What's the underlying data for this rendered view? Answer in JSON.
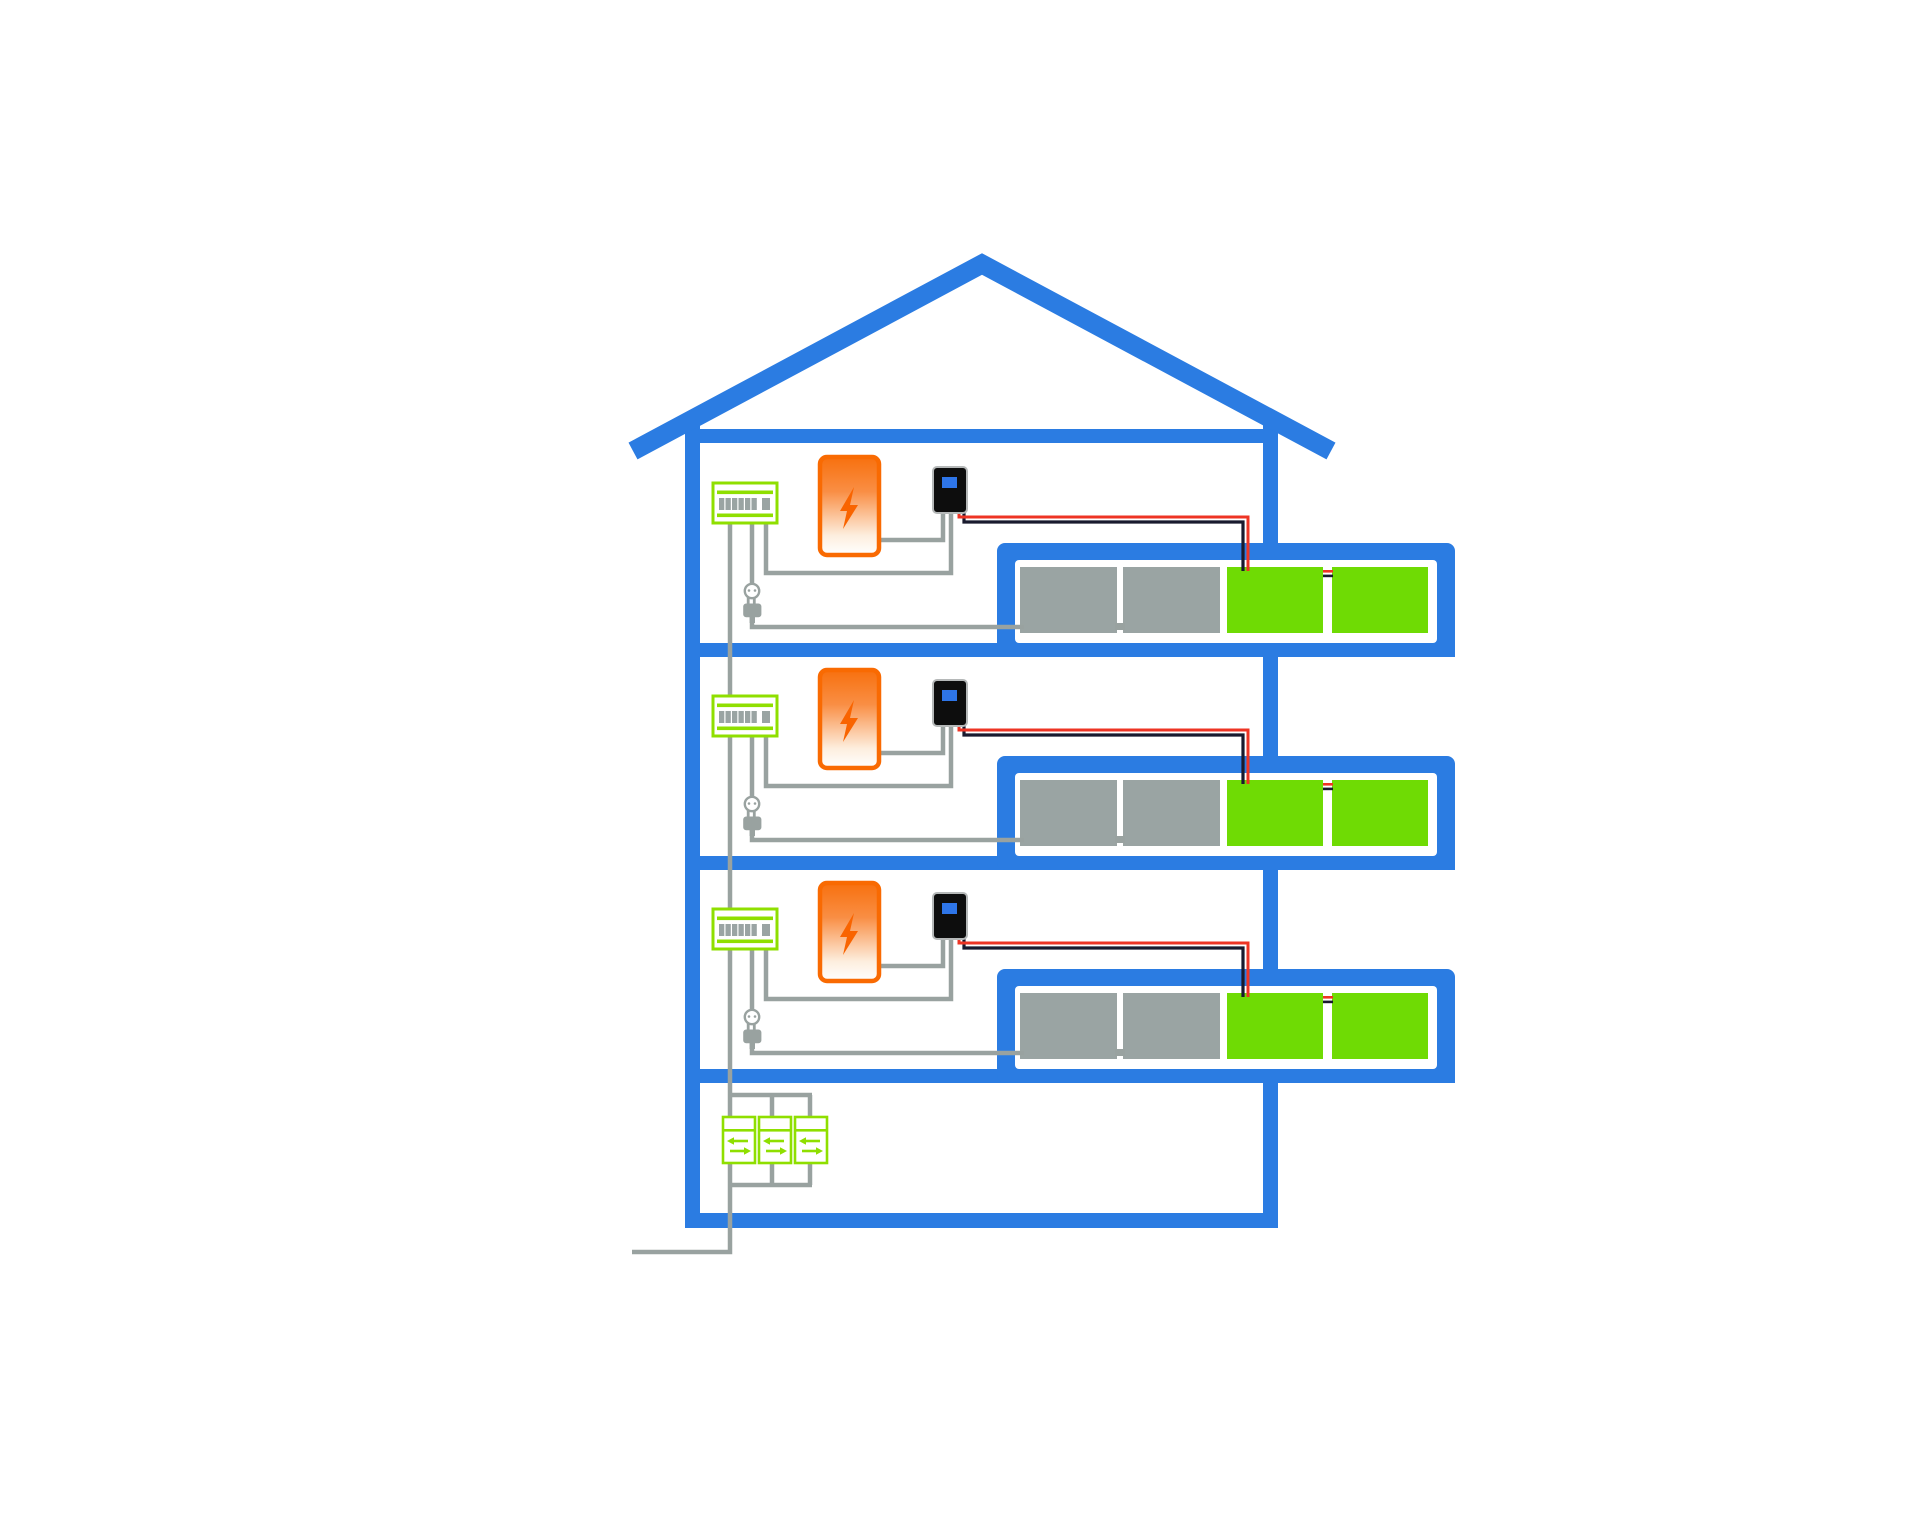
{
  "diagram_type": "multi-family-house-balcony-solar-wiring",
  "colors": {
    "bg": "#ffffff",
    "blue": "#2b7ce2",
    "panelgreen": "#6fdb04",
    "devgreen": "#8fdf00",
    "panelgray": "#9aa4a3",
    "wire": "#99a2a0",
    "orange": "#f96a02",
    "bolt": "#f96400",
    "red": "#ee3424",
    "black": "#191a2e",
    "inv": "#0d0d0d",
    "screen": "#2e75e8"
  },
  "house": {
    "floors": 3,
    "floor_components": [
      "distribution-board",
      "electricity-meter",
      "micro-inverter",
      "power-socket-plug",
      "balcony-solar-panels"
    ],
    "balcony_modules": {
      "gray": 2,
      "green": 2
    },
    "ground_floor_energy_meters": 3,
    "grid_connection": true
  },
  "icons": [
    "lightning-bolt-icon",
    "plug-icon",
    "socket-icon",
    "bidirectional-arrows-icon"
  ]
}
